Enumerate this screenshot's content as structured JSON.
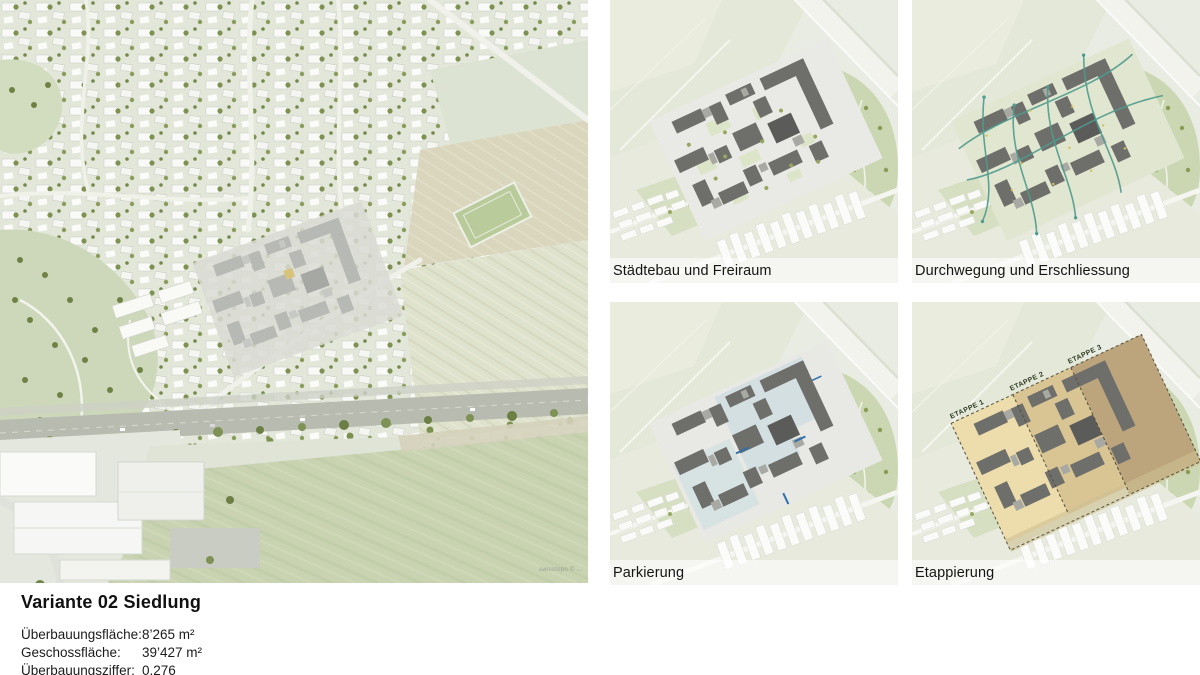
{
  "slide": {
    "title": "Variante 02 Siedlung",
    "stats": [
      {
        "label": "Überbauungsfläche:",
        "value": "8’265 m²"
      },
      {
        "label": "Geschossfläche:",
        "value": "39’427 m²"
      },
      {
        "label": "Überbauungsziffer:",
        "value": "0.276"
      }
    ]
  },
  "main_view": {
    "attribution": "swisstopo © …"
  },
  "panels": [
    {
      "id": "staedtebau-freiraum",
      "label": "Städtebau und Freiraum"
    },
    {
      "id": "durchwegung-erschliessung",
      "label": "Durchwegung und Erschliessung"
    },
    {
      "id": "parkierung",
      "label": "Parkierung"
    },
    {
      "id": "etappierung",
      "label": "Etappierung",
      "stages": [
        "ETAPPE 1",
        "ETAPPE 2",
        "ETAPPE 3"
      ]
    }
  ],
  "colors": {
    "stage1": "#edddac",
    "stage2": "#d9c493",
    "stage3": "#bca57c",
    "path_teal": "#4f9b8e",
    "parking_blue": "#d5dfe1",
    "building_dark": "#6e6e6b",
    "tree_green": "#8a9b55"
  }
}
